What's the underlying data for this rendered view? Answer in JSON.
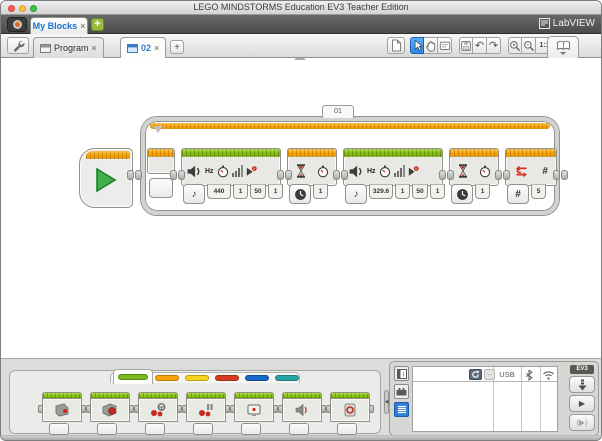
{
  "window": {
    "title": "LEGO MINDSTORMS Education EV3 Teacher Edition"
  },
  "project_bar": {
    "tab_label": "My Blocks",
    "tab_close": "×",
    "add_button": "+",
    "labview_label": "LabVIEW"
  },
  "toolbar": {
    "program_tab_label": "Program",
    "program_tab_close": "×",
    "myblock_tab_label": "02",
    "myblock_tab_close": "×",
    "add_button": "+",
    "zoom_actual_label": "1:1"
  },
  "program": {
    "loop_label": "01",
    "sound1": {
      "hz_label": "Hz",
      "mode_glyph": "♪",
      "play_badge": "0",
      "frequency": "440",
      "duration": "1",
      "volume": "50",
      "play_type": "1"
    },
    "wait1": {
      "seconds": "1"
    },
    "sound2": {
      "hz_label": "Hz",
      "mode_glyph": "♪",
      "play_badge": "0",
      "frequency": "329.6",
      "duration": "1",
      "volume": "50",
      "play_type": "1"
    },
    "wait2": {
      "seconds": "1"
    },
    "loop_end": {
      "hash_label": "#",
      "mode_label": "#",
      "count": "5"
    }
  },
  "palette": {
    "tabs": [
      {
        "name": "action",
        "color": "#79b821",
        "selected": true
      },
      {
        "name": "flow-control",
        "color": "#f8a30b",
        "selected": false
      },
      {
        "name": "sensor",
        "color": "#f8d31b",
        "selected": false
      },
      {
        "name": "data-operations",
        "color": "#d53a21",
        "selected": false
      },
      {
        "name": "advanced",
        "color": "#1866c8",
        "selected": false
      },
      {
        "name": "my-blocks",
        "color": "#27a5a5",
        "selected": false
      }
    ],
    "blocks": [
      "medium-motor",
      "large-motor",
      "move-steering",
      "move-tank",
      "display",
      "sound",
      "brick-status-light"
    ]
  },
  "hardware": {
    "usb_label": "USB",
    "brick_label": "EV3"
  },
  "colors": {
    "sound_header_green": "#8ac215",
    "wait_header_orange": "#f8a408",
    "loop_stripe_orange": "#f8a408",
    "selected_tool_blue": "#2f87e8",
    "project_tab_text_blue": "#1a74d4"
  }
}
